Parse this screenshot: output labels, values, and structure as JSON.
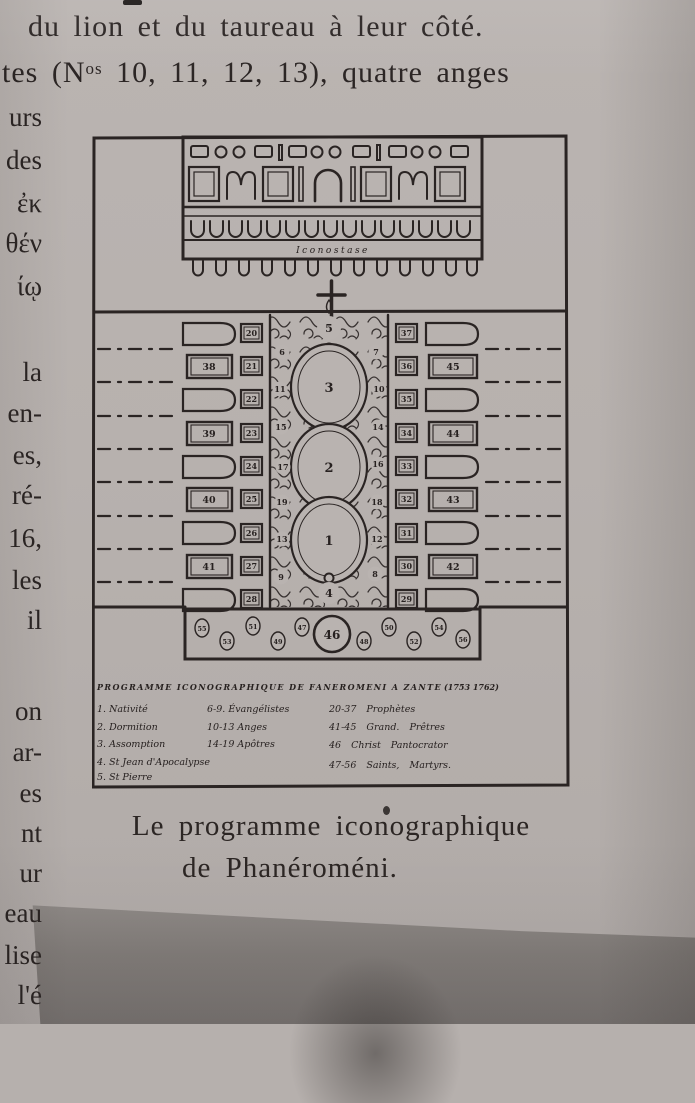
{
  "page": {
    "top_lines": {
      "line1": "du lion et du taureau à leur côté.",
      "line2_pre": "tes (N",
      "line2_sup": "os",
      "line2_post": " 10, 11, 12, 13), quatre anges"
    },
    "margin_fragments": [
      "urs",
      "des",
      "ἐκ",
      "θέν",
      "ίῳ",
      "la",
      "en-",
      "es,",
      "ré-",
      "16,",
      "les",
      "il",
      "on",
      "ar-",
      "es",
      "nt",
      "ur",
      "eau",
      "lise",
      "l'é"
    ],
    "caption_line1": "Le programme iconographique",
    "caption_line2": "de Phanéroméni."
  },
  "figure": {
    "iconostasis_label": "Iconostase",
    "legend": {
      "title": "PROGRAMME ICONOGRAPHIQUE DE FANEROMENI A ZANTE",
      "years": "(1753 1762)",
      "col1": [
        "1. Nativité",
        "2. Dormition",
        "3. Assomption",
        "4. St Jean d'Apocalypse",
        "5. St Pierre"
      ],
      "col2": [
        "6-9. Évangélistes",
        "10-13 Anges",
        "14-19 Apôtres"
      ],
      "col3": [
        "20-37 Prophètes",
        "41-45 Grand. Prêtres",
        "46 Christ Pantocrator",
        "47-56 Saints, Martyrs."
      ]
    },
    "plan": {
      "central_medallions": [
        "5",
        "3",
        "2",
        "1",
        "4"
      ],
      "strip_left_numbers": [
        "6",
        "11",
        "15",
        "17",
        "19",
        "13",
        "9"
      ],
      "strip_right_numbers": [
        "7",
        "10",
        "14",
        "16",
        "18",
        "12",
        "8"
      ],
      "left_inner_boxes": [
        "20",
        "21",
        "22",
        "23",
        "24",
        "25",
        "26",
        "27",
        "28"
      ],
      "right_inner_boxes": [
        "37",
        "36",
        "35",
        "34",
        "33",
        "32",
        "31",
        "30",
        "29"
      ],
      "left_outer_boxes": [
        "38",
        "39",
        "40",
        "41"
      ],
      "right_outer_boxes": [
        "45",
        "44",
        "43",
        "42"
      ],
      "frieze_center": "46",
      "frieze_numbers": [
        "55",
        "53",
        "51",
        "49",
        "47",
        "48",
        "50",
        "52",
        "54",
        "56"
      ]
    }
  },
  "colors": {
    "paper": "#b7b1ae",
    "drawing_ink": "#2a2423",
    "print_ink": "#2b2524",
    "shadow_card": "#827d7a"
  }
}
